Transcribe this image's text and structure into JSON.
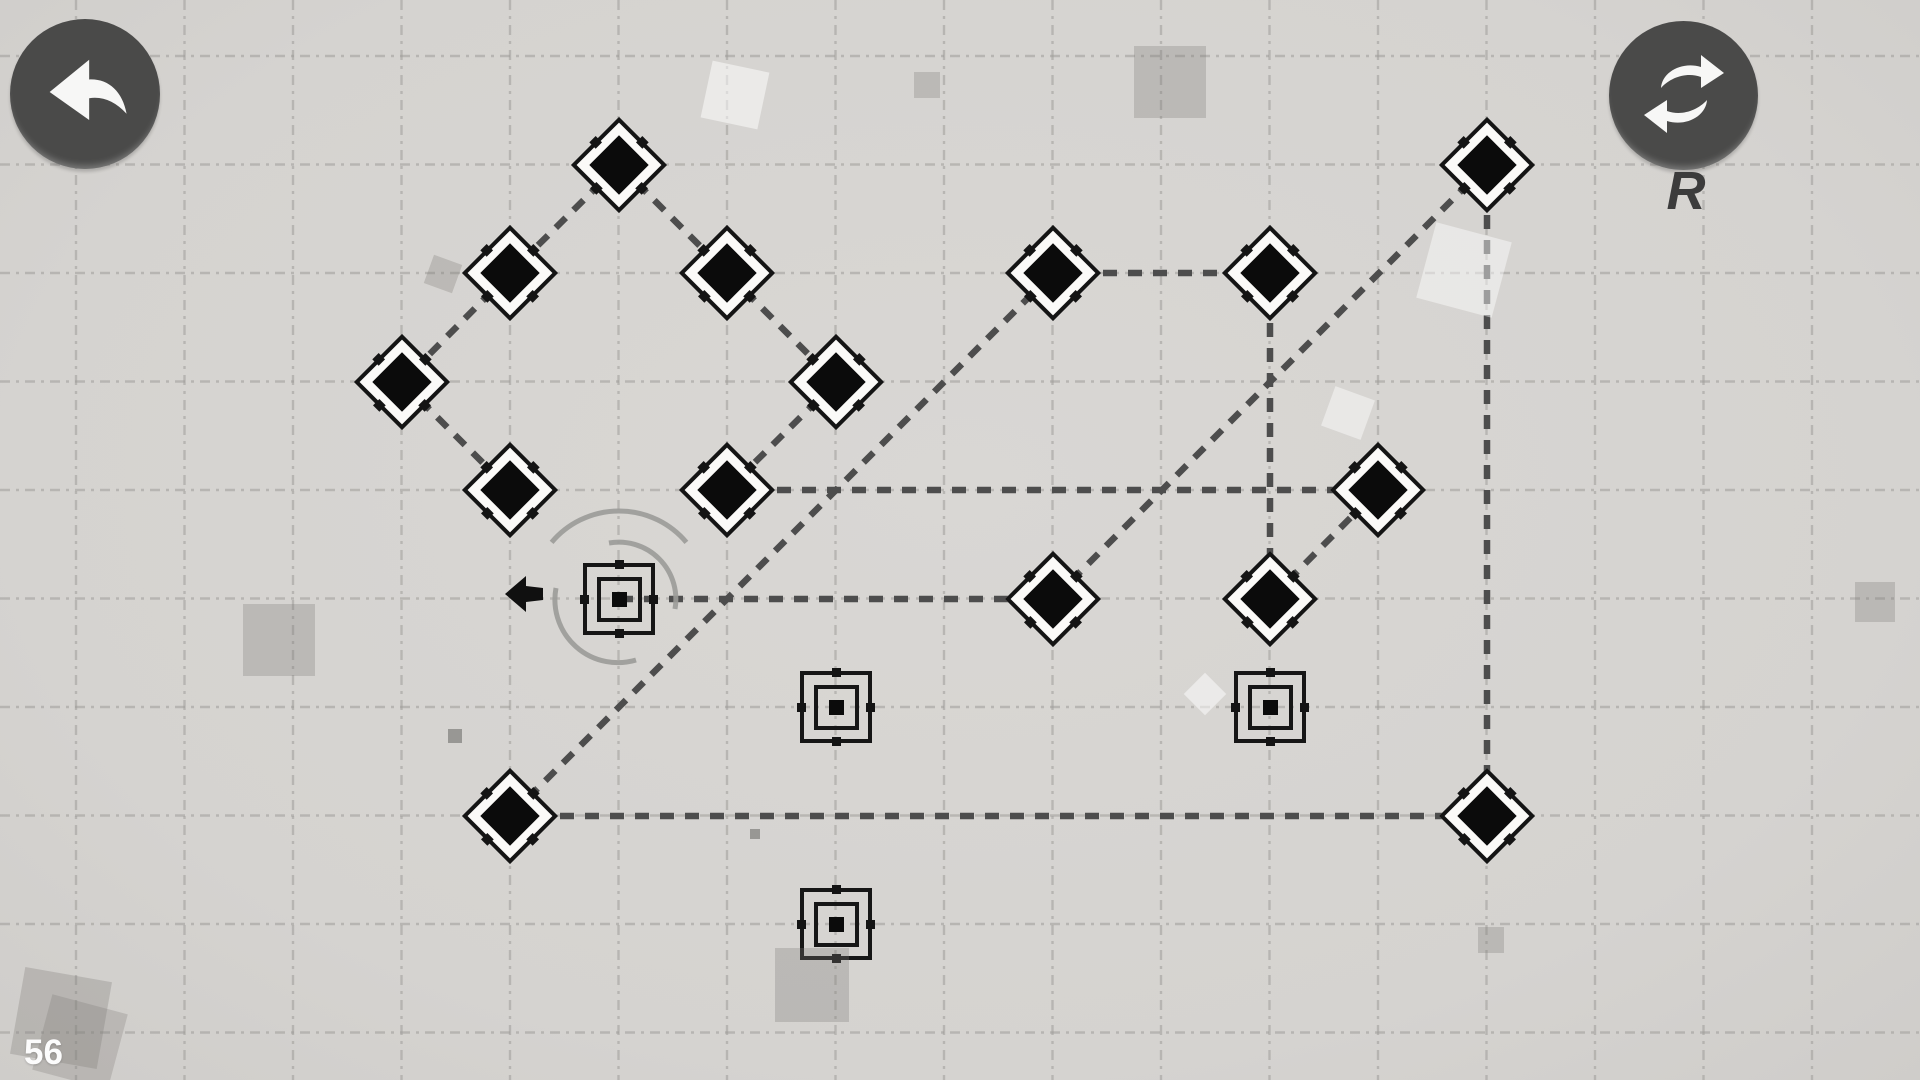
{
  "hud": {
    "level_counter": "56",
    "restart_key_hint": "R",
    "undo_icon": "undo-curved-arrow",
    "restart_icon": "restart-cycle-arrows",
    "colors": {
      "button_bg": "#4a4a49",
      "button_glyph": "#f7f7f6",
      "counter_text": "#fcfcfc",
      "hint_text": "#3c3c3c"
    }
  },
  "board": {
    "background": "#d6d4d1",
    "grid": {
      "spacing": 108.5,
      "offset_x": 76,
      "offset_y": 56,
      "color": "#9f9d9a",
      "dasharray": "10 6 3 6",
      "opacity": 0.55,
      "stroke_width": 2.4
    },
    "edge_style": {
      "color": "#4d4d4d",
      "stroke_width": 6.5,
      "dasharray": "14 11"
    },
    "node_colors": {
      "shape_fill": "#0b0b0b",
      "outline": "#141414",
      "diamond_face": "#fbfaf8"
    },
    "nodes": [
      {
        "id": "d1",
        "type": "diamond",
        "x": 619,
        "y": 165
      },
      {
        "id": "d2",
        "type": "diamond",
        "x": 510,
        "y": 273
      },
      {
        "id": "d3",
        "type": "diamond",
        "x": 727,
        "y": 273
      },
      {
        "id": "d4",
        "type": "diamond",
        "x": 402,
        "y": 382
      },
      {
        "id": "d5",
        "type": "diamond",
        "x": 836,
        "y": 382
      },
      {
        "id": "d6",
        "type": "diamond",
        "x": 510,
        "y": 490
      },
      {
        "id": "d7",
        "type": "diamond",
        "x": 727,
        "y": 490
      },
      {
        "id": "d8",
        "type": "diamond",
        "x": 1053,
        "y": 273
      },
      {
        "id": "d9",
        "type": "diamond",
        "x": 1270,
        "y": 273
      },
      {
        "id": "d10",
        "type": "diamond",
        "x": 1487,
        "y": 165
      },
      {
        "id": "d11",
        "type": "diamond",
        "x": 1378,
        "y": 490
      },
      {
        "id": "d12",
        "type": "diamond",
        "x": 1053,
        "y": 599
      },
      {
        "id": "d13",
        "type": "diamond",
        "x": 1270,
        "y": 599
      },
      {
        "id": "d14",
        "type": "diamond",
        "x": 510,
        "y": 816
      },
      {
        "id": "d15",
        "type": "diamond",
        "x": 1487,
        "y": 816
      },
      {
        "id": "start",
        "type": "start",
        "x": 619,
        "y": 599
      },
      {
        "id": "s1",
        "type": "socket",
        "x": 836,
        "y": 707
      },
      {
        "id": "s2",
        "type": "socket",
        "x": 1270,
        "y": 707
      },
      {
        "id": "s3",
        "type": "socket",
        "x": 836,
        "y": 924
      }
    ],
    "edges": [
      [
        "d1",
        "d2"
      ],
      [
        "d1",
        "d3"
      ],
      [
        "d2",
        "d4"
      ],
      [
        "d4",
        "d6"
      ],
      [
        "d3",
        "d5"
      ],
      [
        "d5",
        "d7"
      ],
      [
        "d7",
        "d11"
      ],
      [
        "d8",
        "d9"
      ],
      [
        "d9",
        "d13"
      ],
      [
        "d13",
        "d11"
      ],
      [
        "d14",
        "d8"
      ],
      [
        "d12",
        "d10"
      ],
      [
        "d10",
        "d15"
      ],
      [
        "d14",
        "d15"
      ],
      [
        "start",
        "d12"
      ]
    ],
    "rotation_arcs": [
      "M 551.6 542.4 A 88 88 0 0 1 686.4 542.4",
      "M 609 543 A 57 57 0 0 1 675 609",
      "M 556 588 A 63 63 0 0 0 636 660"
    ],
    "arc_color": "#9b9b98",
    "pointer_arrow": {
      "points": "505,594 526,576 526,586 543,588 543,600 526,602 526,612",
      "fill": "#101010"
    },
    "decor": [
      {
        "x": 735,
        "y": 95,
        "s": 58,
        "r": 12,
        "c": "rgba(255,255,255,0.50)"
      },
      {
        "x": 927,
        "y": 85,
        "s": 26,
        "r": 0,
        "c": "rgba(125,123,120,0.30)"
      },
      {
        "x": 1170,
        "y": 82,
        "s": 72,
        "r": 0,
        "c": "rgba(125,123,120,0.30)"
      },
      {
        "x": 443,
        "y": 274,
        "s": 30,
        "r": 20,
        "c": "rgba(125,123,120,0.30)"
      },
      {
        "x": 1464,
        "y": 270,
        "s": 78,
        "r": 15,
        "c": "rgba(255,255,255,0.45)"
      },
      {
        "x": 1348,
        "y": 413,
        "s": 42,
        "r": 20,
        "c": "rgba(255,255,255,0.45)"
      },
      {
        "x": 1205,
        "y": 694,
        "s": 30,
        "r": 45,
        "c": "rgba(255,255,255,0.50)"
      },
      {
        "x": 279,
        "y": 640,
        "s": 72,
        "r": 0,
        "c": "rgba(125,123,120,0.30)"
      },
      {
        "x": 61,
        "y": 1018,
        "s": 88,
        "r": 10,
        "c": "rgba(125,123,120,0.30)"
      },
      {
        "x": 812,
        "y": 985,
        "s": 74,
        "r": 0,
        "c": "rgba(125,123,120,0.30)"
      },
      {
        "x": 80,
        "y": 1042,
        "s": 78,
        "r": 15,
        "c": "rgba(125,123,120,0.28)"
      },
      {
        "x": 1491,
        "y": 940,
        "s": 26,
        "r": 0,
        "c": "rgba(125,123,120,0.30)"
      },
      {
        "x": 1875,
        "y": 602,
        "s": 40,
        "r": 0,
        "c": "rgba(125,123,120,0.30)"
      },
      {
        "x": 455,
        "y": 736,
        "s": 14,
        "r": 0,
        "c": "rgba(90,90,88,0.50)"
      },
      {
        "x": 755,
        "y": 834,
        "s": 10,
        "r": 0,
        "c": "rgba(90,90,88,0.50)"
      }
    ]
  }
}
